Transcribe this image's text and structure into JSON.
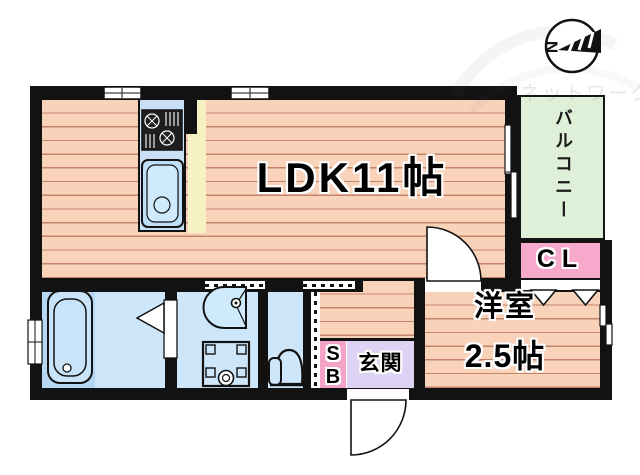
{
  "watermark_text": "ネットワーク",
  "compass": {
    "north_letter": "N"
  },
  "rooms": {
    "ldk": {
      "label": "LDK11帖"
    },
    "balcony": {
      "label": "バルコニー"
    },
    "closet": {
      "label": "CL"
    },
    "western_room": {
      "name": "洋室",
      "size": "2.5帖"
    },
    "entrance": {
      "label": "玄関"
    },
    "shoebox": {
      "line1": "S",
      "line2": "B"
    }
  },
  "fixtures": [
    "bathtub",
    "washbasin",
    "washing-machine-pan",
    "toilet",
    "kitchen-stove",
    "kitchen-sink",
    "sliding-window",
    "hinged-door",
    "folding-door",
    "closet-folding-door"
  ],
  "colors": {
    "wall": "#121212",
    "floor_salmon": "#f9d2ba",
    "floor_line": "#96462855",
    "balcony_green": "#dff0d9",
    "closet_pink": "#f6a9cb",
    "shoebox_pink": "#f3a3c6",
    "entrance_lavender": "#ded3f4",
    "water_blue": "#cde6fa",
    "tub_base_blue": "#b5d7f3",
    "kitchen_counter_blue": "#c8dff5",
    "kitchen_floor_yellow": "#f6f2c3"
  }
}
